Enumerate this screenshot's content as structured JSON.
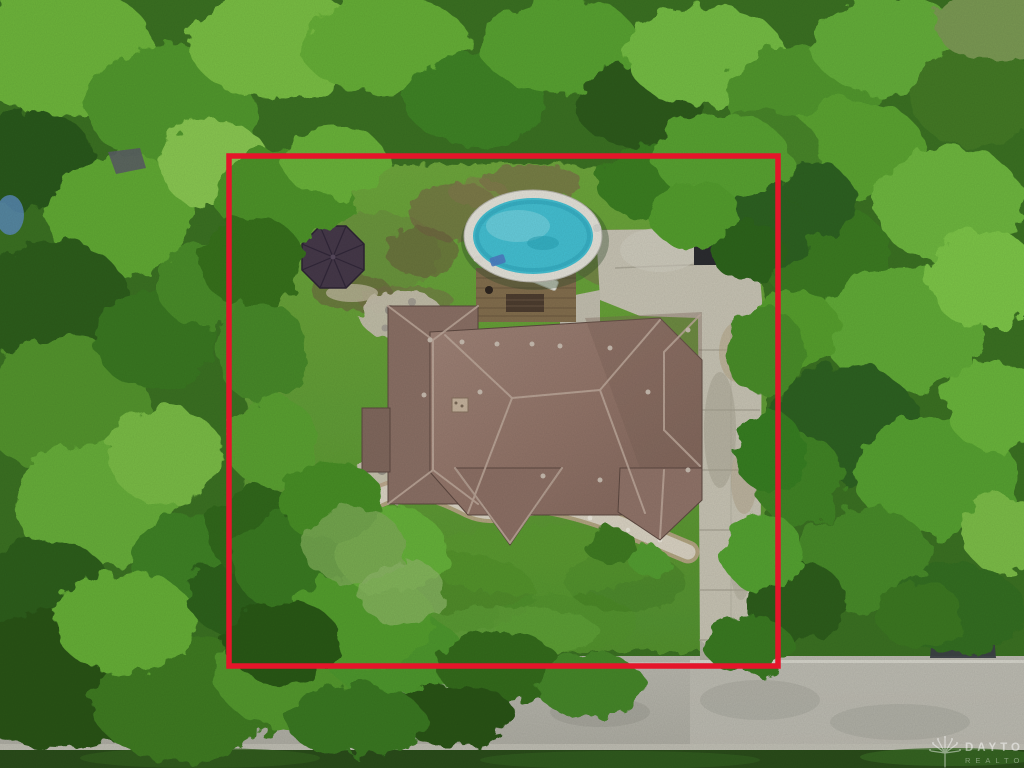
{
  "scene": {
    "type": "aerial-drone-photo",
    "description": "Overhead view of a wooded residential lot: red boundary outline around a house with brown hip roof, oval swimming pool with wooden deck, gazebo, concrete driveway, front lawn, and a street along the bottom edge."
  },
  "boundary": {
    "label": "property-boundary-outline",
    "color": "#e5152a"
  },
  "colors": {
    "pool_water": "#45c3d6",
    "pool_rim": "#e8e6dd",
    "roof_shingles": "#97786c",
    "driveway_concrete": "#cbc7b7",
    "street_asphalt": "#b4b3a9",
    "tree_canopy": "#3c7323",
    "lawn": "#63a037"
  },
  "watermark": {
    "icon": "tree-logo-icon",
    "line1": "DAYTON",
    "line2": "REALTORS"
  }
}
